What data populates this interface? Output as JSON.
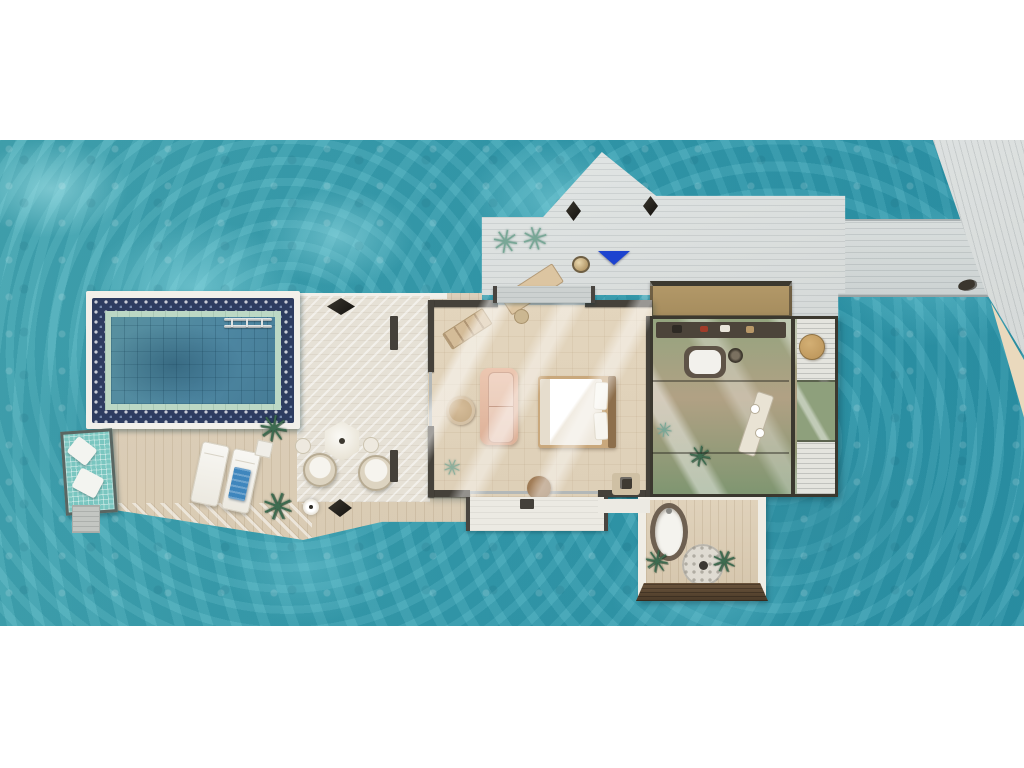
{
  "scene": {
    "kind": "architectural floor plan render, top-down view",
    "subject": "overwater resort villa surrounded by turquoise lagoon",
    "rooms": [
      {
        "name": "entrance-deck"
      },
      {
        "name": "arrival-walkway"
      },
      {
        "name": "jetty"
      },
      {
        "name": "private-pool"
      },
      {
        "name": "pool-deck"
      },
      {
        "name": "sun-deck"
      },
      {
        "name": "lounge-terrace"
      },
      {
        "name": "bedroom"
      },
      {
        "name": "bathroom"
      },
      {
        "name": "outdoor-bathroom-terrace"
      }
    ],
    "objects": [
      {
        "name": "swimming-pool"
      },
      {
        "name": "pool-ladder"
      },
      {
        "name": "hammock-net"
      },
      {
        "name": "hammock-pillows"
      },
      {
        "name": "sun-lounger",
        "count": 2
      },
      {
        "name": "beach-towel"
      },
      {
        "name": "parasol-table"
      },
      {
        "name": "wicker-chair",
        "count": 2
      },
      {
        "name": "floor-lamp",
        "count": 2
      },
      {
        "name": "decor-diamond",
        "count": 4
      },
      {
        "name": "potted-plant",
        "count": 7
      },
      {
        "name": "double-bed"
      },
      {
        "name": "sofa"
      },
      {
        "name": "pouf"
      },
      {
        "name": "writing-desk"
      },
      {
        "name": "bench"
      },
      {
        "name": "side-table"
      },
      {
        "name": "indoor-bathtub"
      },
      {
        "name": "vanity"
      },
      {
        "name": "stool"
      },
      {
        "name": "outdoor-bathtub"
      },
      {
        "name": "rain-shower"
      },
      {
        "name": "entrance-marker-triangle"
      },
      {
        "name": "shell-decor"
      },
      {
        "name": "boat-cleat"
      }
    ]
  },
  "colors": {
    "page_bg": "#ffffff",
    "ocean_base": "#46abb7",
    "ocean_deep": "#2d97ab",
    "ocean_light": "#8fd9e0",
    "deck_gray": "#d5d9d8",
    "walkway_gray": "#ccd2d2",
    "deck_beige": "#d9cbb3",
    "terrace_light": "#e6e1d6",
    "platform_white": "#f2f0ea",
    "pool_navy": "#2d3c60",
    "pool_ring": "#bcd8c5",
    "pool_water": "#4d86a1",
    "interior_floor": "#ded0b8",
    "wall_dark": "#45413a",
    "roof_brown": "#a68d5e",
    "roof_frame": "#3b382f",
    "glass_green": "#94a47f",
    "glass_tan": "#b1a184",
    "sofa_peach": "#ddb198",
    "wood_tan": "#c9a87c",
    "hammock_teal": "#7ac6c0",
    "towel_blue": "#3f86bd",
    "accent_blue": "#1d43cf",
    "plant_green": "#3c6b4f",
    "plant_teal": "#78a796",
    "sand": "#ead9bd",
    "dark_wood": "#6b543c"
  }
}
